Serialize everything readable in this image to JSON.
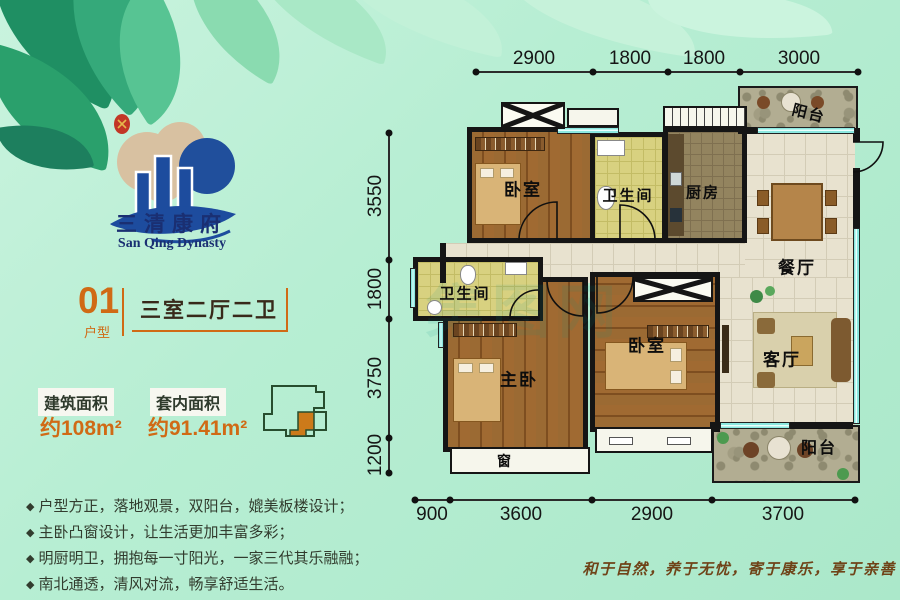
{
  "brand": {
    "logo_cn": "三清康府",
    "logo_en": "San Qing Dynasty"
  },
  "unit": {
    "number": "01",
    "number_label": "户型",
    "layout_name": "三室二厅二卫"
  },
  "areas": {
    "building_label": "建筑面积",
    "building_value": "约108m²",
    "inner_label": "套内面积",
    "inner_value": "约91.41m²"
  },
  "features_bullet": "◆",
  "features": [
    "户型方正，落地观景，双阳台，媲美板楼设计；",
    "主卧凸窗设计，让生活更加丰富多彩；",
    "明厨明卫，拥抱每一寸阳光，一家三代其乐融融；",
    "南北通透，清风对流，畅享舒适生活。"
  ],
  "slogan": "和于自然，养于无忧，寄于康乐，享于亲善",
  "watermark": "集图网",
  "plan": {
    "rooms": {
      "bedroom_top": "卧室",
      "bath_top": "卫生间",
      "kitchen": "厨房",
      "balcony_top": "阳台",
      "dining": "餐厅",
      "bath_left": "卫生间",
      "master": "主卧",
      "bedroom_mid": "卧室",
      "living": "客厅",
      "balcony_bottom": "阳台",
      "bay_window": "窗"
    },
    "dims": {
      "top": [
        "2900",
        "1800",
        "1800",
        "3000"
      ],
      "left": [
        "3550",
        "1800",
        "3750",
        "1200"
      ],
      "bottom": [
        "900",
        "3600",
        "2900",
        "3700"
      ]
    }
  },
  "colors": {
    "accent_orange": "#d06a15",
    "background_mint": "#b7eed3",
    "window_cyan": "#8be8e0",
    "wall_black": "#151515",
    "logo_blue": "#1d4c9e"
  }
}
